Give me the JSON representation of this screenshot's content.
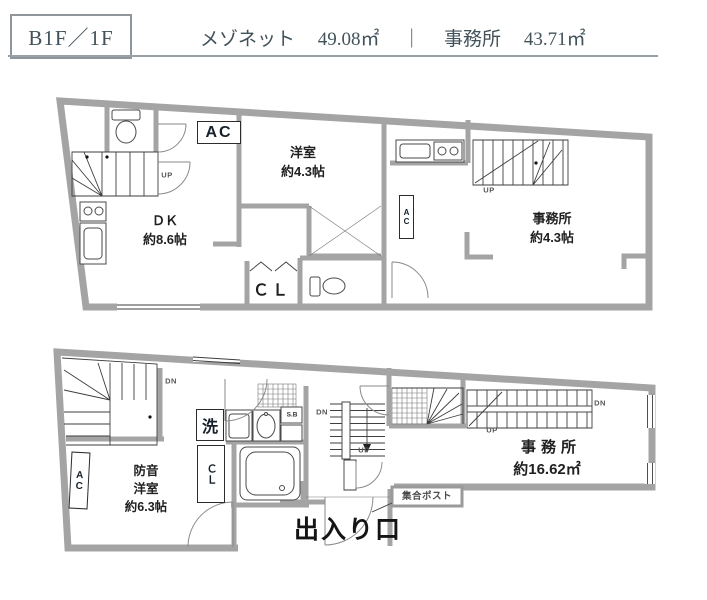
{
  "header": {
    "floor_label": "B1F／1F",
    "unit1_name": "メゾネット",
    "unit1_area": "49.08㎡",
    "divider": "｜",
    "unit2_name": "事務所",
    "unit2_area": "43.71㎡"
  },
  "upper_plan": {
    "ac": "AC",
    "up": "UP",
    "western_room": "洋室\n約4.3帖",
    "dining_kitchen": "ＤＫ\n約8.6帖",
    "closet": "ＣＬ",
    "office": "事務所\n約4.3帖",
    "office_up": "UP",
    "office_ac": "AC"
  },
  "lower_plan": {
    "dn": "DN",
    "ac": "AC",
    "soundproof_room": "防音\n洋室\n約6.3帖",
    "washer": "洗",
    "closet": "ＣＬ",
    "shoe_box": "S.B",
    "center_dn": "DN",
    "center_up": "UP",
    "office_name": "事務所",
    "office_area": "約16.62㎡",
    "office_dn": "DN",
    "office_up": "UP",
    "mailbox": "集合ポスト",
    "entrance": "出入り口"
  },
  "colors": {
    "wall": "#a4a4a4",
    "line": "#3e3e3e",
    "label": "#1f1f1f",
    "header_text": "#42525b"
  }
}
